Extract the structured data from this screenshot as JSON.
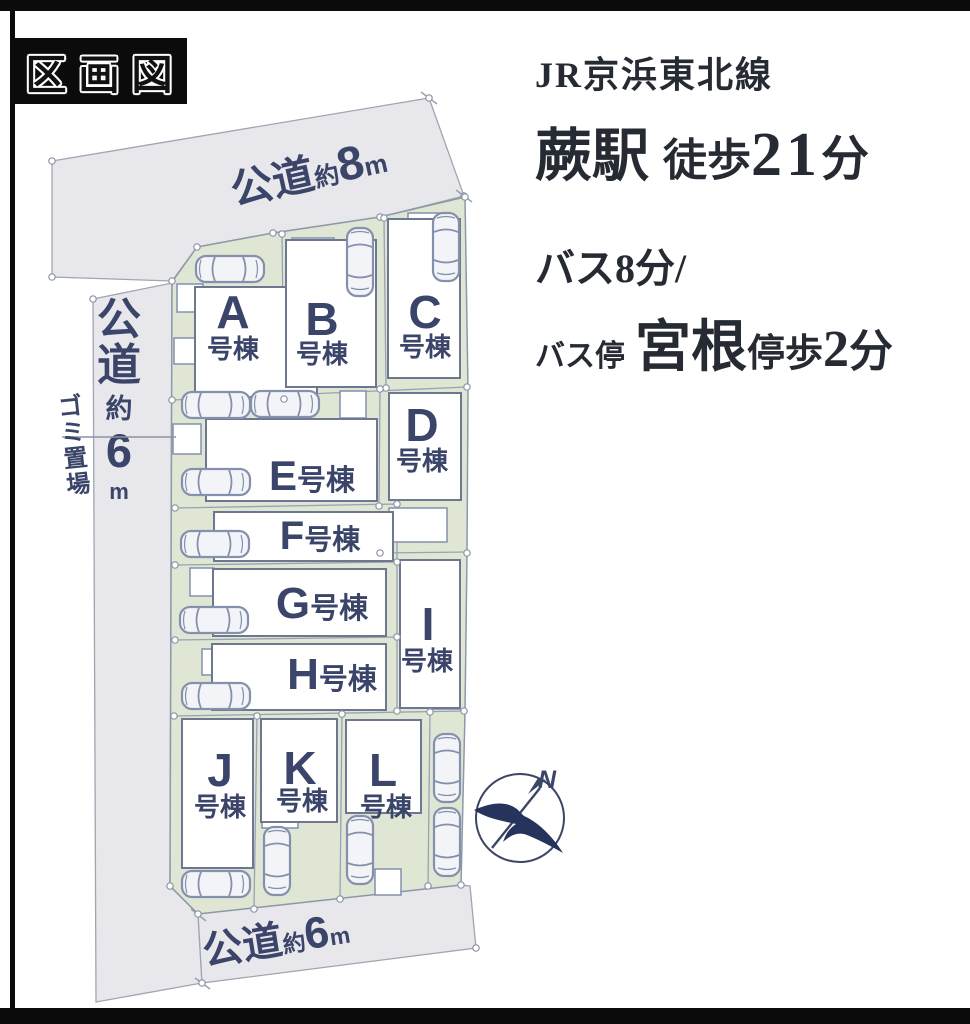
{
  "page": {
    "badge": "区画図"
  },
  "access": {
    "railway_line": "JR京浜東北線",
    "station": "蕨駅",
    "walk_label": "徒歩",
    "walk_minutes": "21",
    "walk_unit": "分",
    "bus_line": "バス8分/",
    "bus_stop_label": "バス停",
    "bus_stop_name": "宮根",
    "stop_walk_label": "停歩",
    "stop_walk_minutes": "2",
    "stop_walk_unit": "分"
  },
  "map": {
    "roads": {
      "top": {
        "name": "公道",
        "approx": "約",
        "width": "8",
        "unit": "m"
      },
      "left": {
        "chars": [
          "公",
          "道",
          "約",
          "6",
          "m"
        ]
      },
      "bottom": {
        "name": "公道",
        "approx": "約",
        "width": "6",
        "unit": "m"
      }
    },
    "garbage": {
      "chars": [
        "ゴ",
        "ミ",
        "置",
        "場"
      ]
    },
    "lots": [
      {
        "id": "A",
        "suffix": "号棟"
      },
      {
        "id": "B",
        "suffix": "号棟"
      },
      {
        "id": "C",
        "suffix": "号棟"
      },
      {
        "id": "D",
        "suffix": "号棟"
      },
      {
        "id": "E",
        "suffix": "号棟"
      },
      {
        "id": "F",
        "suffix": "号棟"
      },
      {
        "id": "G",
        "suffix": "号棟"
      },
      {
        "id": "H",
        "suffix": "号棟"
      },
      {
        "id": "I",
        "suffix": "号棟"
      },
      {
        "id": "J",
        "suffix": "号棟"
      },
      {
        "id": "K",
        "suffix": "号棟"
      },
      {
        "id": "L",
        "suffix": "号棟"
      }
    ],
    "compass": {
      "north": "N"
    },
    "colors": {
      "parcel_green": "#dfe7d4",
      "road_gray": "#e8e7eb",
      "label_navy": "#3a4569",
      "frame_black": "#0b0b0b",
      "compass_navy": "#26335c"
    }
  }
}
